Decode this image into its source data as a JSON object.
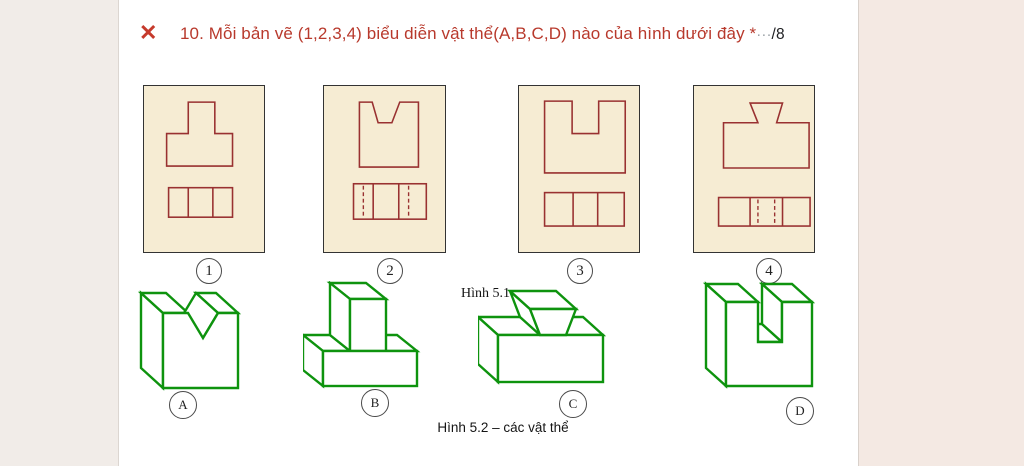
{
  "page": {
    "background_color": "#ffffff",
    "left_band_color": "#f1ece8",
    "right_band_color": "#f4e9e3"
  },
  "header": {
    "close_icon": "✕",
    "close_icon_color": "#c63a2c",
    "question_text": "10. Mỗi bản vẽ (1,2,3,4) biểu diễn vật thể(A,B,C,D) nào của hình dưới đây ",
    "required_marker": "*",
    "score_ellipsis": "···",
    "score": "/8",
    "question_color": "#b8392c"
  },
  "figure_5_1": {
    "label": "Hình 5.1",
    "panel_numbers": [
      "1",
      "2",
      "3",
      "4"
    ],
    "panel_background": "#f6ecd3",
    "panel_border_color": "#333333",
    "drawing_line_color": "#993131",
    "panel_descriptions": [
      "front view T-shape block, top view rectangle divided in three",
      "front view square with trapezoid notch, top view with two dashed hidden lines outside center",
      "front view square with rectangular U-notch, top view rectangle divided in three",
      "front view wide block with dovetail tenon on top, top view with two dashed hidden lines inside center"
    ]
  },
  "figure_5_2": {
    "caption": "Hình 5.2 – các vật thể",
    "object_letters": [
      "A",
      "B",
      "C",
      "D"
    ],
    "drawing_line_color": "#0e930e",
    "object_descriptions": [
      "cube with V-groove cut in top",
      "T-shaped stepped block",
      "wide block with dovetail tenon on top",
      "cube with rectangular slot cut in top"
    ]
  }
}
